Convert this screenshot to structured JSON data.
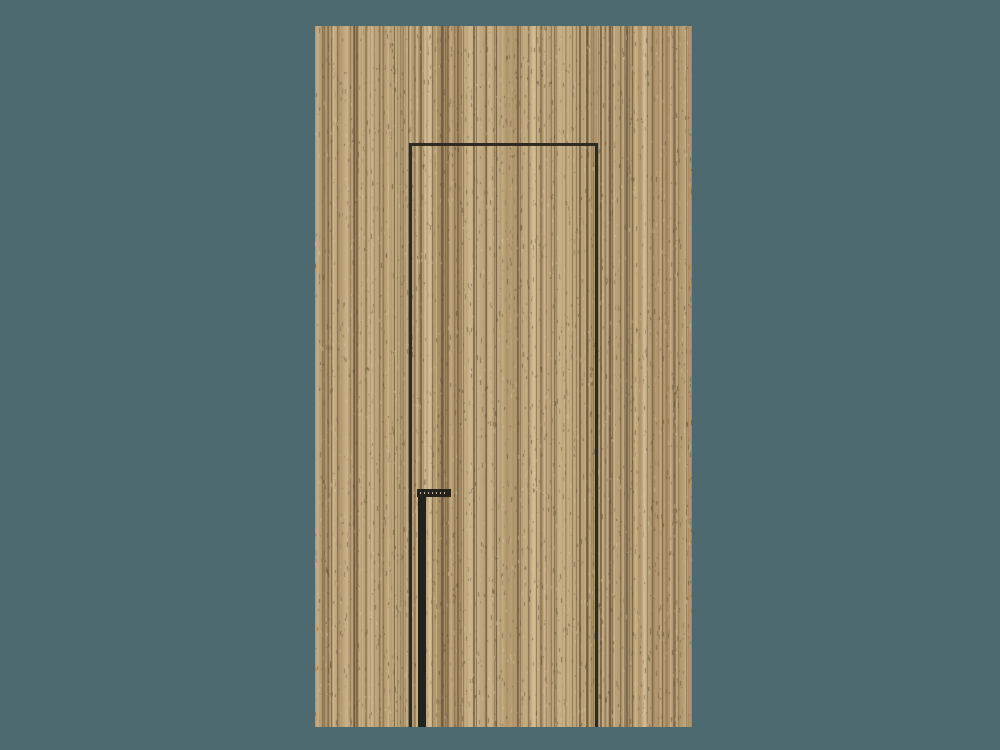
{
  "scene": {
    "width": 1000,
    "height": 750,
    "background_color": "#4d6a71",
    "subject": "flush wooden door panel with vertical plank grain, concealed reveal frame and long black pull handle"
  },
  "door": {
    "x": 315,
    "y": 26,
    "width": 377,
    "height": 701,
    "wood": {
      "base_color": "#c0a67c",
      "dark_tone": "#a2865c",
      "light_tone": "#d6c095",
      "grain_dark": "#5a4830",
      "speckle_light": "#ebdcb9"
    }
  },
  "reveal_frame": {
    "color": "#2d2b24",
    "left_x": 409,
    "right_x": 595,
    "top_y": 143,
    "line_width": 3
  },
  "handle": {
    "color": "#23221d",
    "bar": {
      "x": 418,
      "top": 490,
      "width": 8,
      "bottom": 727
    },
    "end_cap": {
      "x": 417,
      "y": 489,
      "width": 34,
      "height": 8,
      "dot_color": "#c9b68c"
    }
  }
}
